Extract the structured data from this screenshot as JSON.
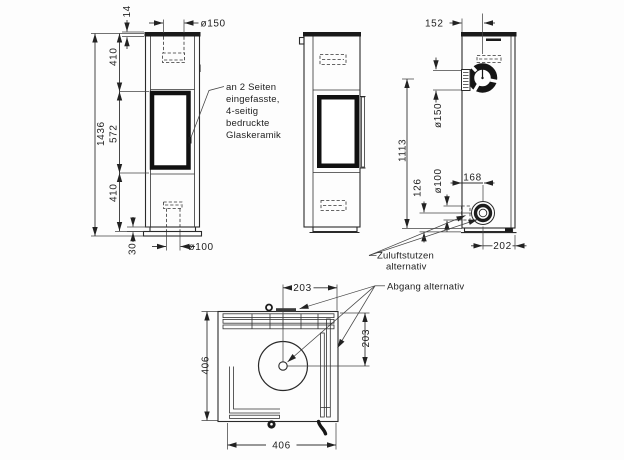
{
  "views": {
    "front": {
      "dim_total_height": "1436",
      "dim_upper_section": "410",
      "dim_glass_section": "572",
      "dim_lower_section": "410",
      "dim_base_height": "30",
      "dim_top_plate": "14",
      "dim_flue_collar_diameter": "ø150",
      "dim_floor_duct_diameter": "ø100"
    },
    "back": {
      "dim_flue_center_from_edge": "152",
      "dim_rear_flue_diameter": "ø150",
      "dim_flue_center_height": "1113",
      "dim_air_inlet_center_height": "126",
      "dim_air_inlet_diameter": "ø100",
      "dim_air_inlet_from_left": "168",
      "dim_air_inlet_from_right": "202"
    },
    "plan": {
      "dim_depth": "406",
      "dim_width": "406",
      "dim_flue_offset_horizontal": "203",
      "dim_flue_offset_vertical": "203"
    }
  },
  "annotations": {
    "glass_note": [
      "an 2 Seiten",
      "eingefasste,",
      "4-seitig",
      "bedruckte",
      "Glaskeramik"
    ],
    "air_inlet_note_line1": "Zuluftstutzen",
    "air_inlet_note_line2": "alternativ",
    "flue_outlet_note": "Abgang alternativ"
  }
}
